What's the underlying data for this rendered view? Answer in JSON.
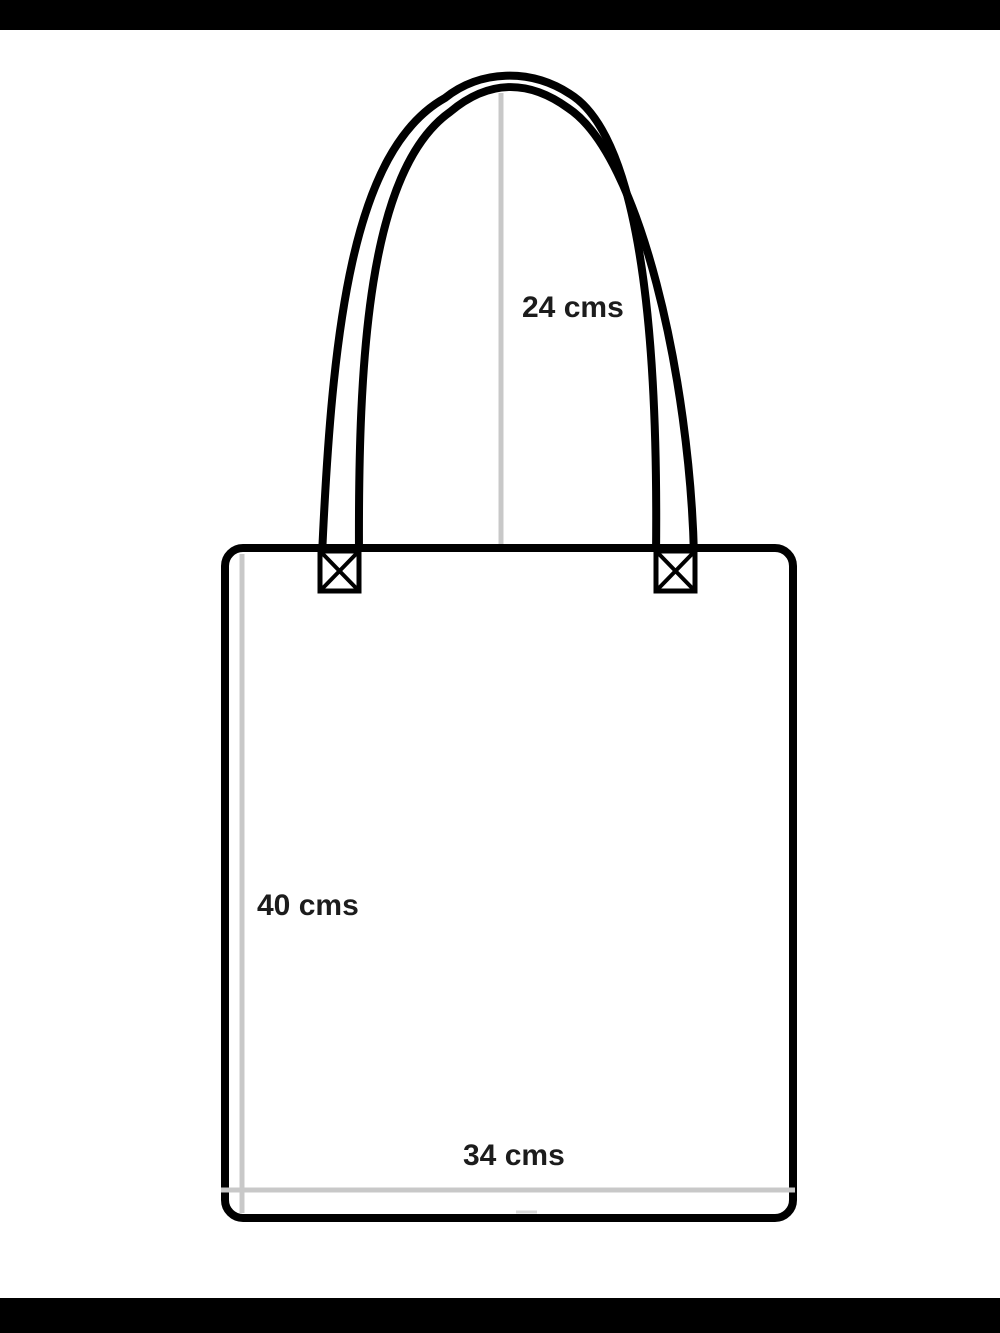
{
  "page": {
    "background_color": "#ffffff",
    "letterbox_color": "#000000"
  },
  "diagram": {
    "subject": "tote-bag-dimension-diagram",
    "outline_color": "#000000",
    "measure_line_color": "#c8c8c8",
    "tick_color": "#d9d9d9",
    "label_color": "#1c1c1c",
    "fill_color": "#ffffff",
    "measurements": {
      "handle_height": {
        "label": "24 cms",
        "value": 24,
        "unit": "cms"
      },
      "bag_height": {
        "label": "40 cms",
        "value": 40,
        "unit": "cms"
      },
      "bag_width": {
        "label": "34 cms",
        "value": 34,
        "unit": "cms"
      }
    }
  }
}
